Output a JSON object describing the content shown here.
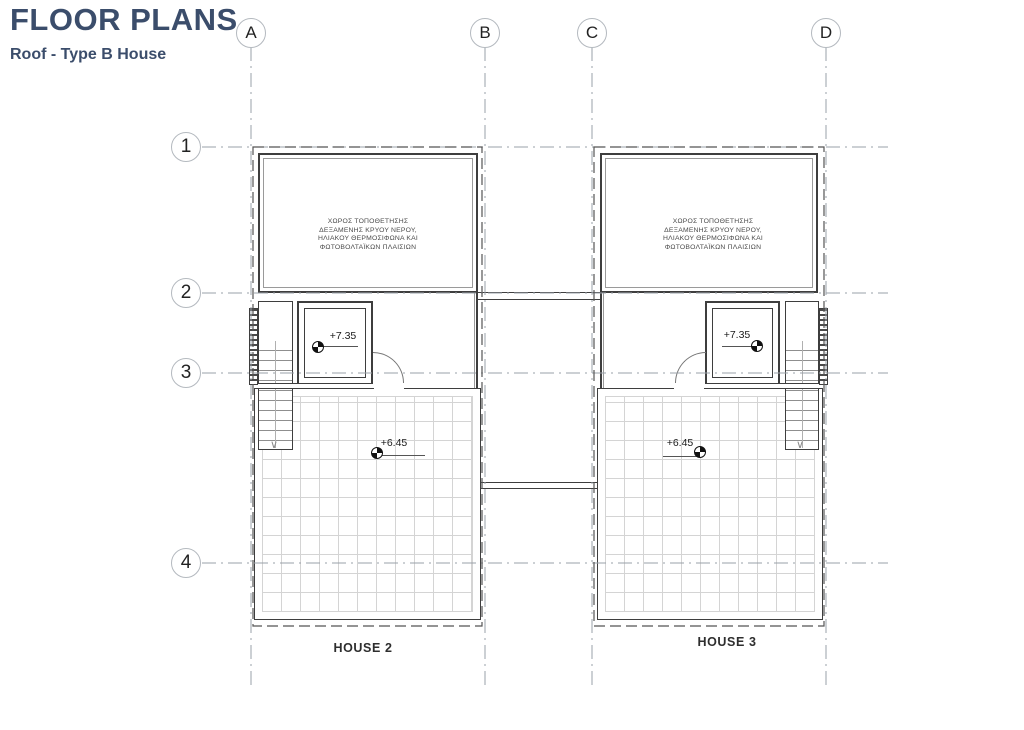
{
  "header": {
    "title": "FLOOR PLANS",
    "subtitle": "Roof - Type B House",
    "title_color": "#3b4d6b"
  },
  "grid": {
    "columns": [
      "A",
      "B",
      "C",
      "D"
    ],
    "rows": [
      "1",
      "2",
      "3",
      "4"
    ]
  },
  "plan": {
    "annotation_lines": [
      "ΧΩΡΟΣ ΤΟΠΟΘΕΤΗΣΗΣ",
      "ΔΕΞΑΜΕΝΗΣ ΚΡΥΟΥ ΝΕΡΟΥ,",
      "ΗΛΙΑΚΟΥ ΘΕΡΜΟΣΙΦΩΝΑ ΚΑΙ",
      "ΦΩΤΟΒΟΛΤΑΪΚΩΝ ΠΛΑΙΣΙΩΝ"
    ],
    "houses": [
      {
        "label": "HOUSE 2",
        "upper_level": "+7.35",
        "terrace_level": "+6.45"
      },
      {
        "label": "HOUSE 3",
        "upper_level": "+7.35",
        "terrace_level": "+6.45"
      }
    ],
    "colors": {
      "wall": "#3e3e3e",
      "grid_line": "#9aa0a8",
      "hidden_line": "#555555",
      "tile_line": "#d4d4d4"
    }
  }
}
